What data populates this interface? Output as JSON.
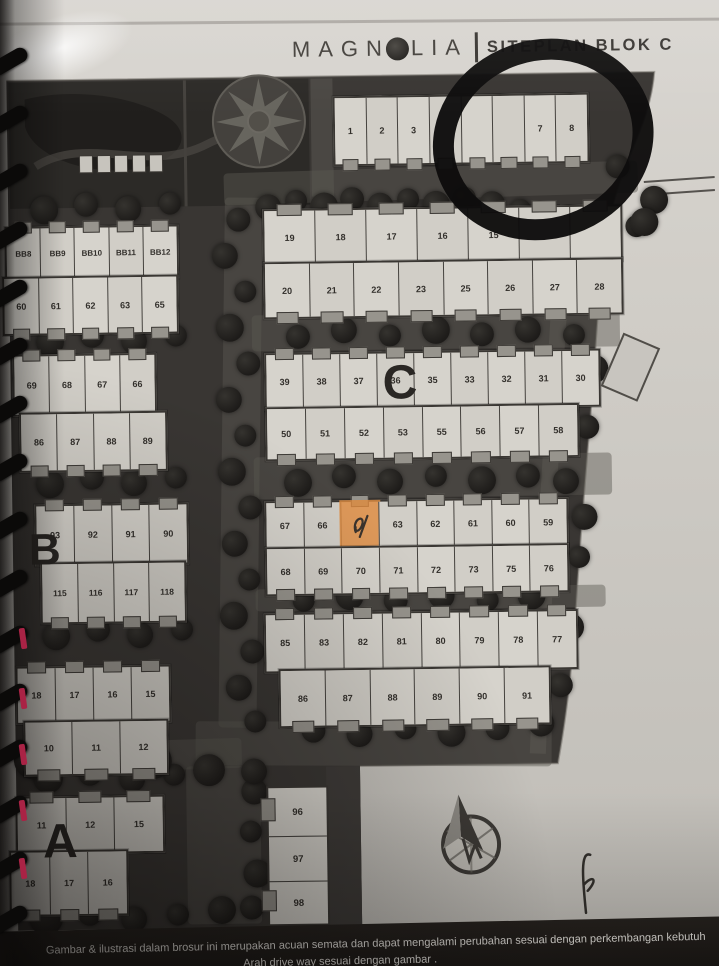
{
  "header": {
    "brand_prefix": "MAGN",
    "brand_suffix": "LIA",
    "divider": "|",
    "section_title": "SITEPLAN BLOK C"
  },
  "plan": {
    "area_labels": [
      {
        "text": "C",
        "x": 384,
        "y": 360,
        "size": 48
      },
      {
        "text": "B",
        "x": 28,
        "y": 524,
        "size": 44
      },
      {
        "text": "A",
        "x": 38,
        "y": 814,
        "size": 48
      }
    ],
    "lot_rows": [
      {
        "id": "c-1-8",
        "x": 338,
        "y": 96,
        "w": 252,
        "h": 66,
        "notch": "bottom",
        "labels": [
          "1",
          "2",
          "3",
          "",
          "",
          "",
          "7",
          "8"
        ]
      },
      {
        "id": "c-19-15",
        "x": 266,
        "y": 208,
        "w": 356,
        "h": 53,
        "notch": "top",
        "labels": [
          "19",
          "18",
          "17",
          "16",
          "15",
          "",
          ""
        ]
      },
      {
        "id": "c-20-28",
        "x": 266,
        "y": 261,
        "w": 356,
        "h": 53,
        "notch": "bottom",
        "labels": [
          "20",
          "21",
          "22",
          "23",
          "25",
          "26",
          "27",
          "28"
        ]
      },
      {
        "id": "c-39-30",
        "x": 266,
        "y": 352,
        "w": 332,
        "h": 54,
        "notch": "top",
        "labels": [
          "39",
          "38",
          "37",
          "36",
          "35",
          "33",
          "32",
          "31",
          "30"
        ]
      },
      {
        "id": "c-50-58",
        "x": 266,
        "y": 406,
        "w": 310,
        "h": 50,
        "notch": "bottom",
        "labels": [
          "50",
          "51",
          "52",
          "53",
          "55",
          "56",
          "57",
          "58"
        ]
      },
      {
        "id": "c-67-59",
        "x": 264,
        "y": 500,
        "w": 300,
        "h": 46,
        "notch": "top",
        "labels": [
          "67",
          "66",
          "",
          "63",
          "62",
          "61",
          "60",
          "59"
        ],
        "marked": 2
      },
      {
        "id": "c-68-76",
        "x": 264,
        "y": 546,
        "w": 300,
        "h": 45,
        "notch": "bottom",
        "labels": [
          "68",
          "69",
          "70",
          "71",
          "72",
          "73",
          "75",
          "76"
        ]
      },
      {
        "id": "c-85-77",
        "x": 262,
        "y": 612,
        "w": 310,
        "h": 56,
        "notch": "top",
        "labels": [
          "85",
          "83",
          "82",
          "81",
          "80",
          "79",
          "78",
          "77"
        ]
      },
      {
        "id": "c-86-91",
        "x": 276,
        "y": 668,
        "w": 268,
        "h": 55,
        "notch": "bottom",
        "labels": [
          "86",
          "87",
          "88",
          "89",
          "90",
          "91"
        ]
      },
      {
        "id": "b-bb8-12",
        "x": 8,
        "y": 222,
        "w": 170,
        "h": 50,
        "notch": "top",
        "labels": [
          "BB8",
          "BB9",
          "BB10",
          "BB11",
          "BB12"
        ],
        "fs": 8
      },
      {
        "id": "b-60-65",
        "x": 5,
        "y": 272,
        "w": 172,
        "h": 55,
        "notch": "bottom",
        "labels": [
          "60",
          "61",
          "62",
          "63",
          "65"
        ]
      },
      {
        "id": "b-69-66",
        "x": 14,
        "y": 350,
        "w": 140,
        "h": 58,
        "notch": "top",
        "labels": [
          "69",
          "68",
          "67",
          "66"
        ]
      },
      {
        "id": "b-86-89",
        "x": 20,
        "y": 408,
        "w": 144,
        "h": 56,
        "notch": "bottom",
        "labels": [
          "86",
          "87",
          "88",
          "89"
        ]
      },
      {
        "id": "b-93-90",
        "x": 34,
        "y": 500,
        "w": 150,
        "h": 58,
        "notch": "top",
        "labels": [
          "93",
          "92",
          "91",
          "90"
        ]
      },
      {
        "id": "b-115-118",
        "x": 39,
        "y": 558,
        "w": 142,
        "h": 58,
        "notch": "bottom",
        "labels": [
          "115",
          "116",
          "117",
          "118"
        ],
        "fs": 8.5
      },
      {
        "id": "b-18-15",
        "x": 13,
        "y": 662,
        "w": 151,
        "h": 54,
        "notch": "top",
        "labels": [
          "18",
          "17",
          "16",
          "15"
        ]
      },
      {
        "id": "b-10-12",
        "x": 20,
        "y": 716,
        "w": 141,
        "h": 52,
        "notch": "bottom",
        "labels": [
          "10",
          "11",
          "12"
        ]
      },
      {
        "id": "a-11-15",
        "x": 11,
        "y": 792,
        "w": 145,
        "h": 54,
        "notch": "top",
        "labels": [
          "11",
          "12",
          "15"
        ]
      },
      {
        "id": "a-18-16",
        "x": 4,
        "y": 846,
        "w": 115,
        "h": 62,
        "notch": "bottom",
        "labels": [
          "18",
          "17",
          "16"
        ]
      }
    ],
    "lot_column": {
      "id": "col-96-98",
      "x": 262,
      "y": 785,
      "w": 58,
      "cells": [
        {
          "label": "96",
          "h": 48,
          "notch": true
        },
        {
          "label": "97",
          "h": 44,
          "notch": false
        },
        {
          "label": "98",
          "h": 42,
          "notch": true
        }
      ]
    }
  },
  "annotations": {
    "marker_circle": "hand-drawn circle around lots 7-8",
    "highlighted_lot": "orange highlighted lot with handwritten mark",
    "pen_mark": "handwritten pen stroke on margin"
  },
  "footer": {
    "line1": "Gambar & ilustrasi dalam brosur ini merupakan acuan semata dan dapat mengalami perubahan sesuai dengan perkembangan kebutuh",
    "line2": "Arah drive way sesuai dengan gambar ."
  },
  "colors": {
    "paper": "#d6d3cd",
    "plan_background": "#393633",
    "lot_fill": "#d6d3cc",
    "tree": "#1d1b19",
    "marker_ink": "#0e0d0c",
    "highlight_orange": "#de8b40",
    "footer_band": "#211e1b",
    "footer_text": "#e9e6e1",
    "binding_red": "#a92345"
  }
}
